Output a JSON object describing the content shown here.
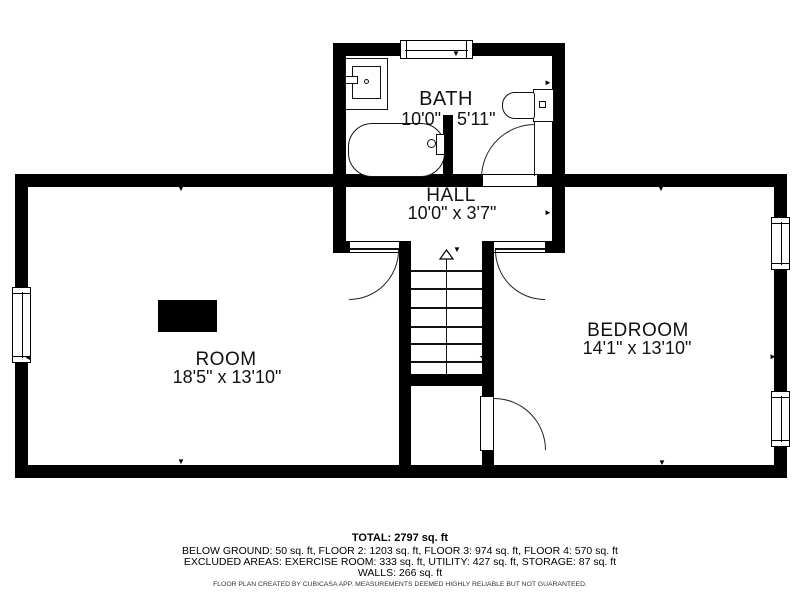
{
  "floor_plan": {
    "rooms": {
      "bath": {
        "name": "BATH",
        "dim_left": "10'0\"",
        "dim_right": "5'11\""
      },
      "hall": {
        "name": "HALL",
        "dims": "10'0\" x 3'7\""
      },
      "room": {
        "name": "ROOM",
        "dims": "18'5\" x 13'10\""
      },
      "bedroom": {
        "name": "BEDROOM",
        "dims": "14'1\" x 13'10\""
      }
    },
    "footer": {
      "total": "TOTAL: 2797 sq. ft",
      "floors": "BELOW GROUND: 50 sq. ft, FLOOR 2: 1203 sq. ft, FLOOR 3: 974 sq. ft, FLOOR 4: 570 sq. ft",
      "excluded": "EXCLUDED AREAS: EXERCISE ROOM: 333 sq. ft, UTILITY: 427 sq. ft, STORAGE: 87 sq. ft",
      "walls": "WALLS: 266 sq. ft",
      "disclaimer": "FLOOR PLAN CREATED BY CUBICASA APP. MEASUREMENTS DEEMED HIGHLY RELIABLE BUT NOT GUARANTEED."
    },
    "icons": {
      "tick_down": "▼",
      "tick_up": "▲",
      "tick_left": "◄",
      "tick_right": "►"
    },
    "colors": {
      "wall": "#000000",
      "background": "#ffffff"
    }
  }
}
